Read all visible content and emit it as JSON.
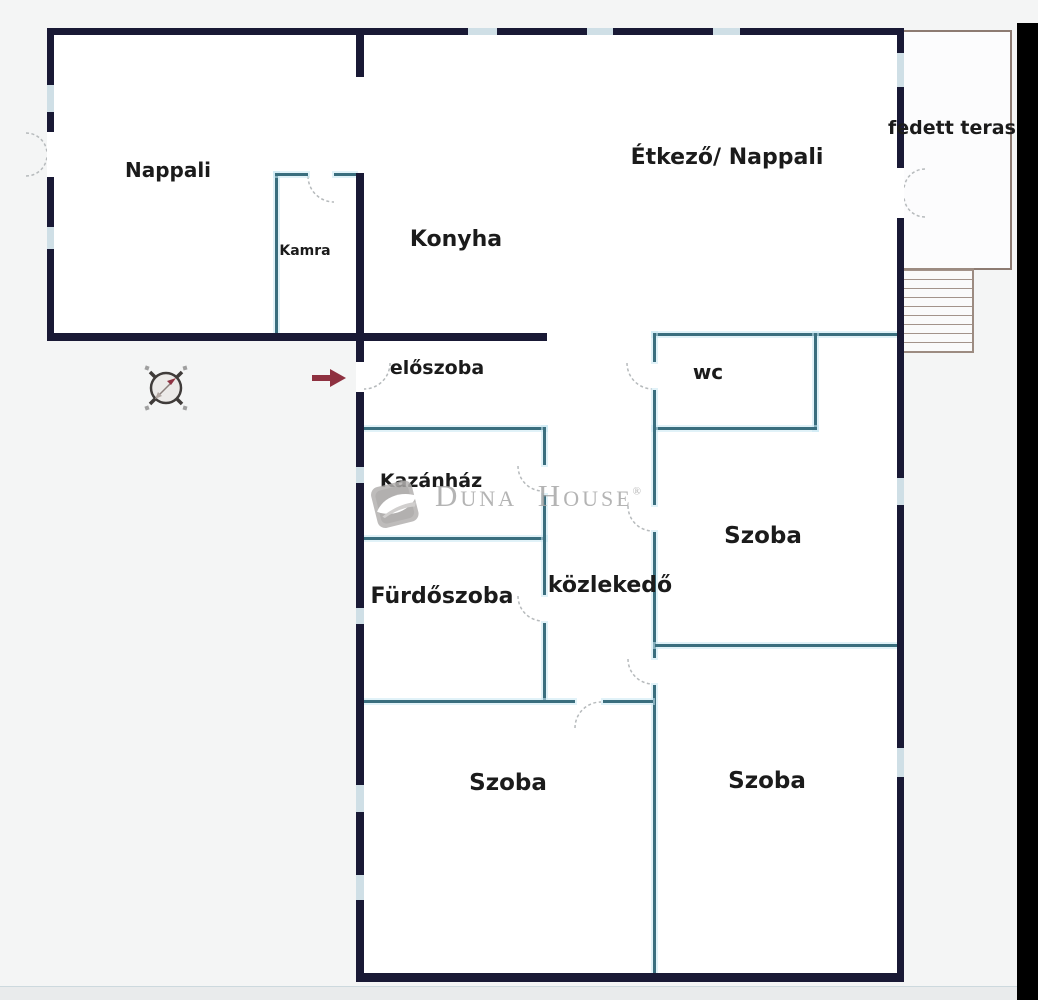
{
  "plan": {
    "type": "floor-plan",
    "brand_watermark": "Duna House",
    "brand_registered": "®"
  },
  "rooms": {
    "nappali": {
      "label": "Nappali"
    },
    "kamra": {
      "label": "Kamra"
    },
    "konyha": {
      "label": "Konyha"
    },
    "etkezo": {
      "label": "Étkező/ Nappali"
    },
    "terasz": {
      "label": "fedett teras"
    },
    "eloszoba": {
      "label": "előszoba"
    },
    "wc": {
      "label": "wc"
    },
    "kazanhaz": {
      "label": "Kazánház"
    },
    "szoba_kozep": {
      "label": "Szoba"
    },
    "furdoszoba": {
      "label": "Fürdőszoba"
    },
    "kozlekedo": {
      "label": "közlekedő"
    },
    "szoba_bal": {
      "label": "Szoba"
    },
    "szoba_jobb": {
      "label": "Szoba"
    }
  },
  "colors": {
    "wall_dark": "#191935",
    "wall_thin": "#3a6e7e",
    "window_gap": "#cfdfe6",
    "terrace_outline": "#8d7b72",
    "entrance_arrow": "#8e3140",
    "compass_needle": "#8f3342",
    "watermark_gray": "#a7a7a7",
    "black_bar": "#000000",
    "background": "#f4f5f5",
    "interior": "#ffffff"
  }
}
